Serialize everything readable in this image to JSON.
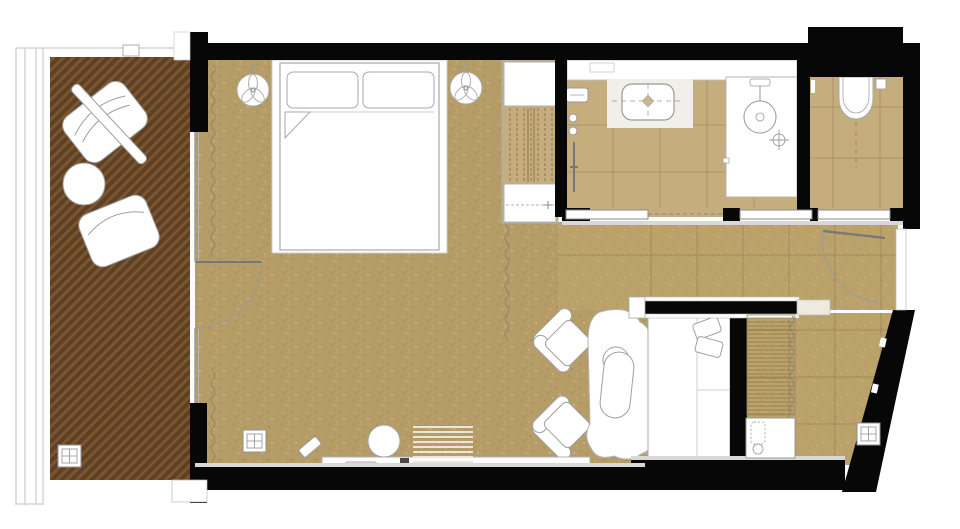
{
  "meta": {
    "drawing_type": "architectural floor plan",
    "subject": "hotel guest room suite with balcony",
    "visible_text": []
  },
  "palette": {
    "bg": "#ffffff",
    "wall": "#070707",
    "floor_main": "#b69d67",
    "floor_hall": "#bba26b",
    "floor_tile": "#c6ad7d",
    "deck_dark": "#5e4124",
    "deck_light": "#7a5530",
    "furniture_fill": "#ffffff",
    "furniture_line": "#a0a0a0",
    "trim": "#d8d8d8",
    "glass_line": "#b5b5b5",
    "grid_line": "rgba(80,55,15,0.22)",
    "hatch_line": "rgba(90,65,25,0.55)"
  },
  "rooms": [
    {
      "name": "balcony-terrace",
      "floor": "wood deck (diagonal hatch)"
    },
    {
      "name": "bedroom-living-room",
      "floor": "speckled carpet"
    },
    {
      "name": "bathroom",
      "floor": "tile"
    },
    {
      "name": "wc",
      "floor": "tile"
    },
    {
      "name": "corridor",
      "floor": "tile"
    },
    {
      "name": "dressing-entry",
      "floor": "tile"
    },
    {
      "name": "daybed-nook",
      "floor": "speckled carpet"
    }
  ],
  "furniture": [
    {
      "name": "double-bed",
      "details": "two pillows, folded sheet corner"
    },
    {
      "name": "pendant-lamp",
      "count": 2
    },
    {
      "name": "outdoor-lounge-chair",
      "count": 2
    },
    {
      "name": "outdoor-round-table",
      "count": 1
    },
    {
      "name": "outdoor-board-table",
      "count": 1
    },
    {
      "name": "wardrobe-closet",
      "details": "shelf top, hanging rail, bottom shelf"
    },
    {
      "name": "armchair",
      "count": 2
    },
    {
      "name": "chaise-longue",
      "count": 1
    },
    {
      "name": "daybed",
      "details": "two cushions"
    },
    {
      "name": "desk-console",
      "details": "with stool"
    },
    {
      "name": "round-pouf",
      "count": 1
    },
    {
      "name": "slatted-bench",
      "count": 1
    },
    {
      "name": "dressing-shelves",
      "count": 1
    },
    {
      "name": "minibar-cabinet",
      "count": 1
    }
  ],
  "fixtures": [
    {
      "name": "vanity-washbasin"
    },
    {
      "name": "walk-in-shower",
      "details": "rain head and floor drain"
    },
    {
      "name": "wall-hung-toilet",
      "details": "flush plate"
    },
    {
      "name": "sliding-door",
      "count": 3
    },
    {
      "name": "entry-swing-door",
      "count": 1
    },
    {
      "name": "balcony-swing-door",
      "count": 1
    },
    {
      "name": "curtain-track",
      "count": 3
    },
    {
      "name": "floor-outlet-box",
      "count": 3
    },
    {
      "name": "towel-bar",
      "count": 1
    }
  ]
}
